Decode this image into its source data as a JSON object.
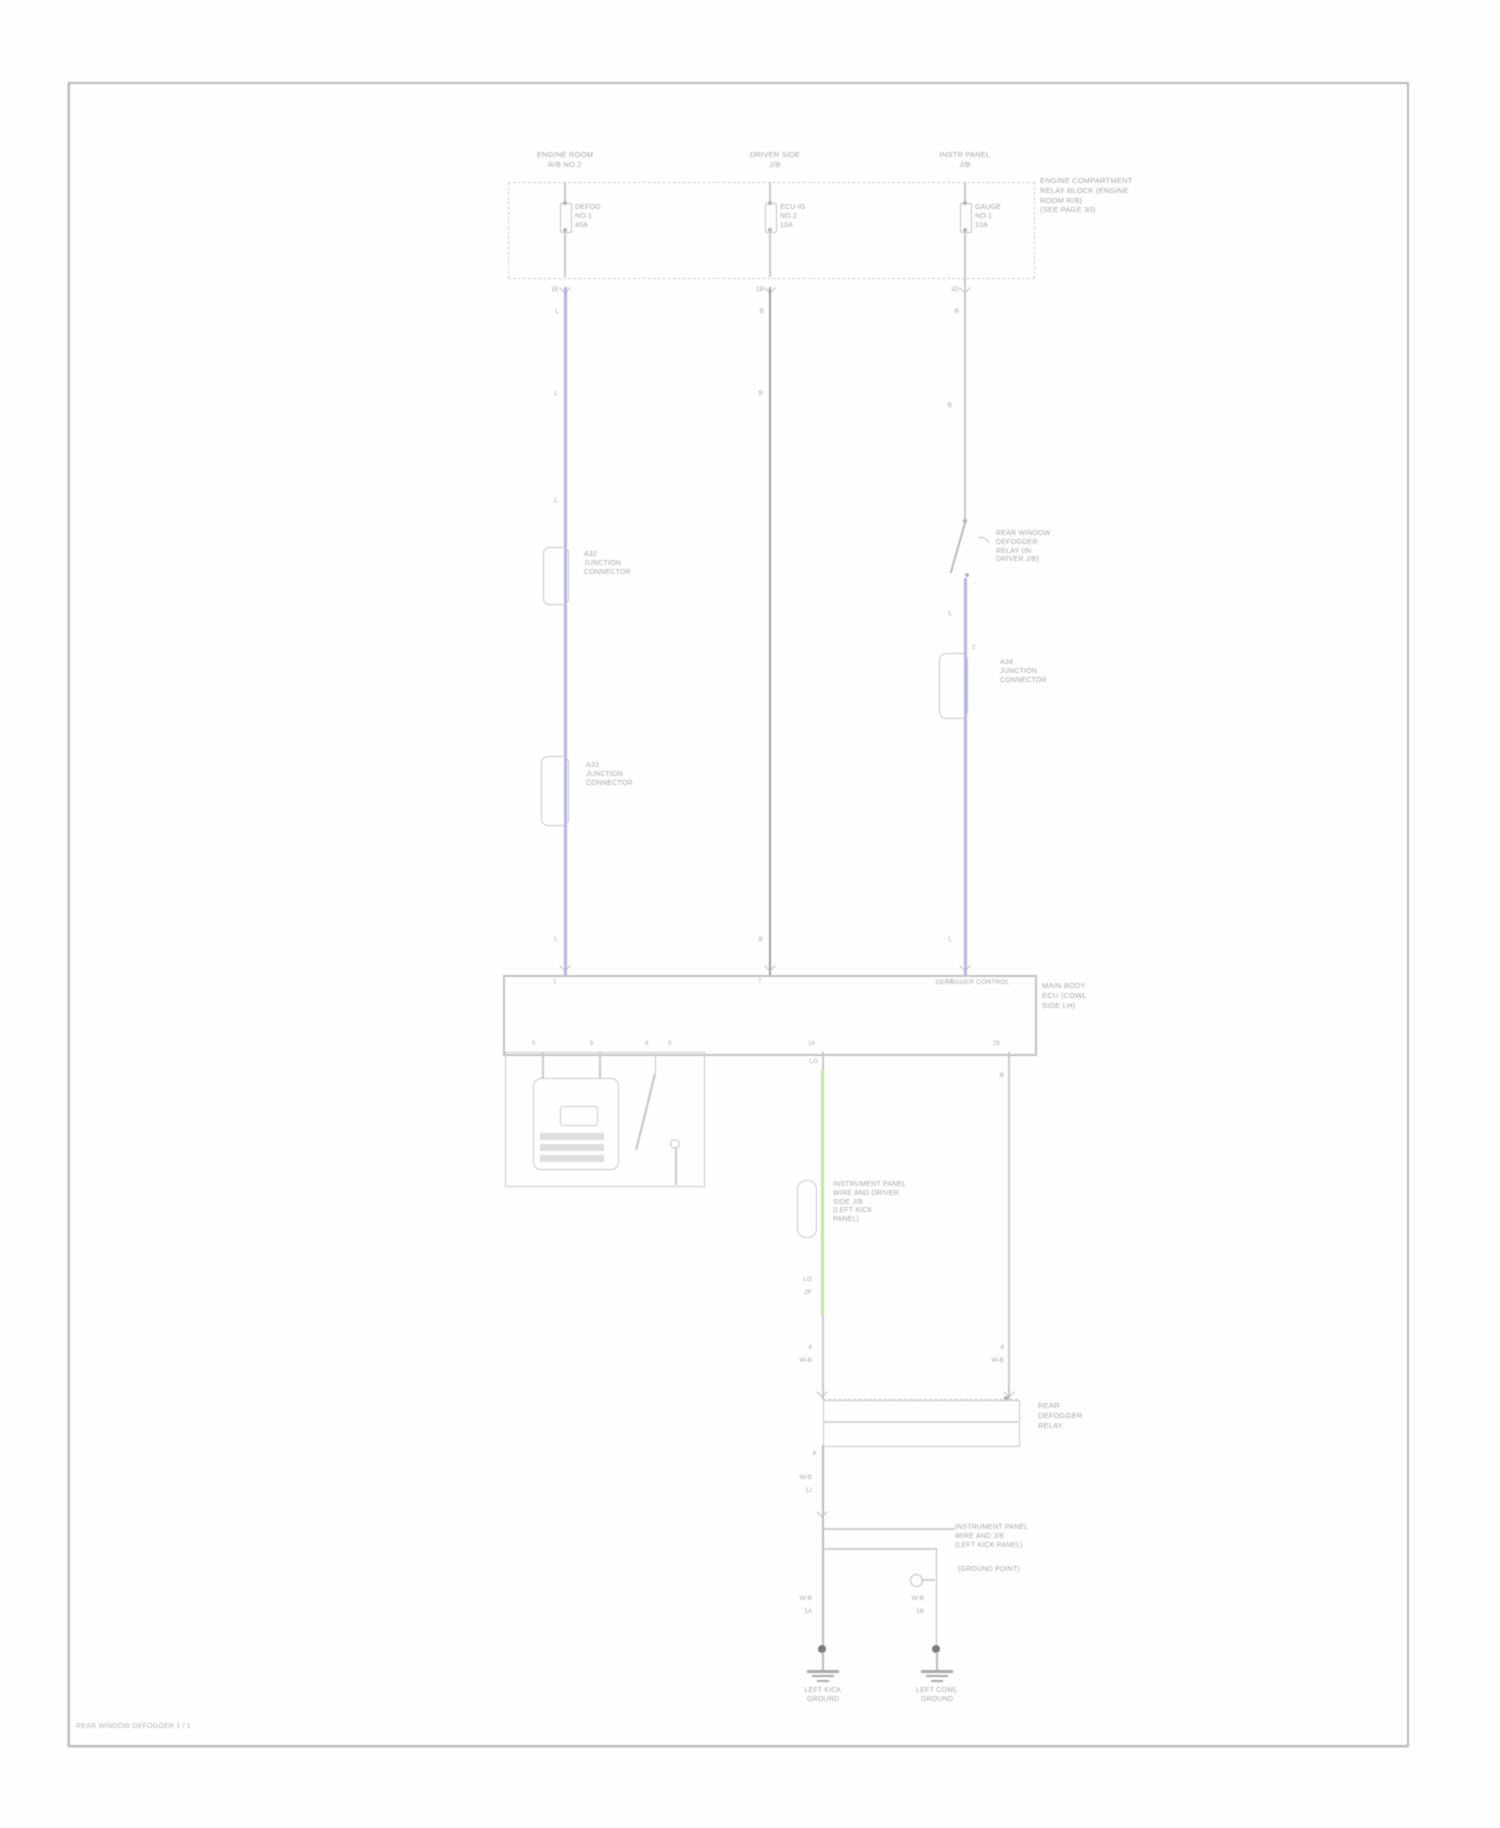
{
  "footer": "REAR WINDOW DEFOGGER  1 / 1",
  "colors": {
    "blue": "#b1b5ec",
    "green": "#bfe7a6",
    "gray_dark": "#9d9da0",
    "gray_light": "#c9c9c9"
  },
  "fusebox": {
    "headers": [
      {
        "a": "ENGINE ROOM",
        "b": "R/B NO.2"
      },
      {
        "a": "DRIVER SIDE",
        "b": "J/B"
      },
      {
        "a": "INSTR PANEL",
        "b": "J/B"
      }
    ],
    "fuses": [
      {
        "a": "DEFOG",
        "b": "NO.1",
        "c": "40A"
      },
      {
        "a": "ECU-IG",
        "b": "NO.2",
        "c": "10A"
      },
      {
        "a": "GAUGE",
        "b": "NO.1",
        "c": "10A"
      }
    ],
    "note": {
      "a": "ENGINE COMPARTMENT",
      "b": "RELAY BLOCK (ENGINE",
      "c": "ROOM R/B)",
      "d": "(SEE PAGE 30)"
    }
  },
  "junctions": [
    {
      "a": "A32",
      "b": "JUNCTION",
      "c": "CONNECTOR"
    },
    {
      "a": "A33",
      "b": "JUNCTION",
      "c": "CONNECTOR"
    },
    {
      "a": "A34",
      "b": "JUNCTION",
      "c": "CONNECTOR"
    }
  ],
  "relay": {
    "a": "REAR WINDOW",
    "b": "DEFOGGER",
    "c": "RELAY (IN",
    "d": "DRIVER J/B)"
  },
  "ecu": {
    "inner": "DEFOGGER CONTROL",
    "a": "MAIN BODY",
    "b": "ECU (COWL",
    "c": "SIDE LH)"
  },
  "ip": {
    "a": "INSTRUMENT PANEL",
    "b": "WIRE AND DRIVER",
    "c": "SIDE J/B",
    "d": "(LEFT KICK",
    "e": "PANEL)"
  },
  "relayrow": {
    "a": "REAR",
    "b": "DEFOGGER",
    "c": "RELAY"
  },
  "gp": {
    "a": "INSTRUMENT PANEL",
    "b": "WIRE AND J/B",
    "c": "(LEFT KICK PANEL)",
    "d": "(GROUND POINT)"
  },
  "grounds": [
    {
      "a": "LEFT KICK",
      "b": "GROUND"
    },
    {
      "a": "LEFT COWL",
      "b": "GROUND"
    }
  ],
  "wl": {
    "f1p": "1E",
    "f1c": "L",
    "f2p": "1B",
    "f2c": "B",
    "f3p": "1D",
    "f3c": "B",
    "c1a": "L",
    "c1b": "L",
    "c1c": "L",
    "c2a": "B",
    "c2b": "B",
    "c3a": "B",
    "c3b": "L",
    "c3c": "L",
    "jpin": "2",
    "e1": "1",
    "e2": "7",
    "e3": "14",
    "s1": "5",
    "s2": "6",
    "s3": "8",
    "s4": "9",
    "s5": "14",
    "s6": "28",
    "glg": "LG",
    "g1": "LG",
    "g2": "2F",
    "g3": "4",
    "g4": "W-B",
    "rb": "B",
    "r1": "4",
    "r2": "W-B",
    "d1": "4",
    "d2": "W-B",
    "d3": "1J",
    "d4": "W-B",
    "d5": "1A",
    "d6": "W-B",
    "d7": "1B"
  }
}
